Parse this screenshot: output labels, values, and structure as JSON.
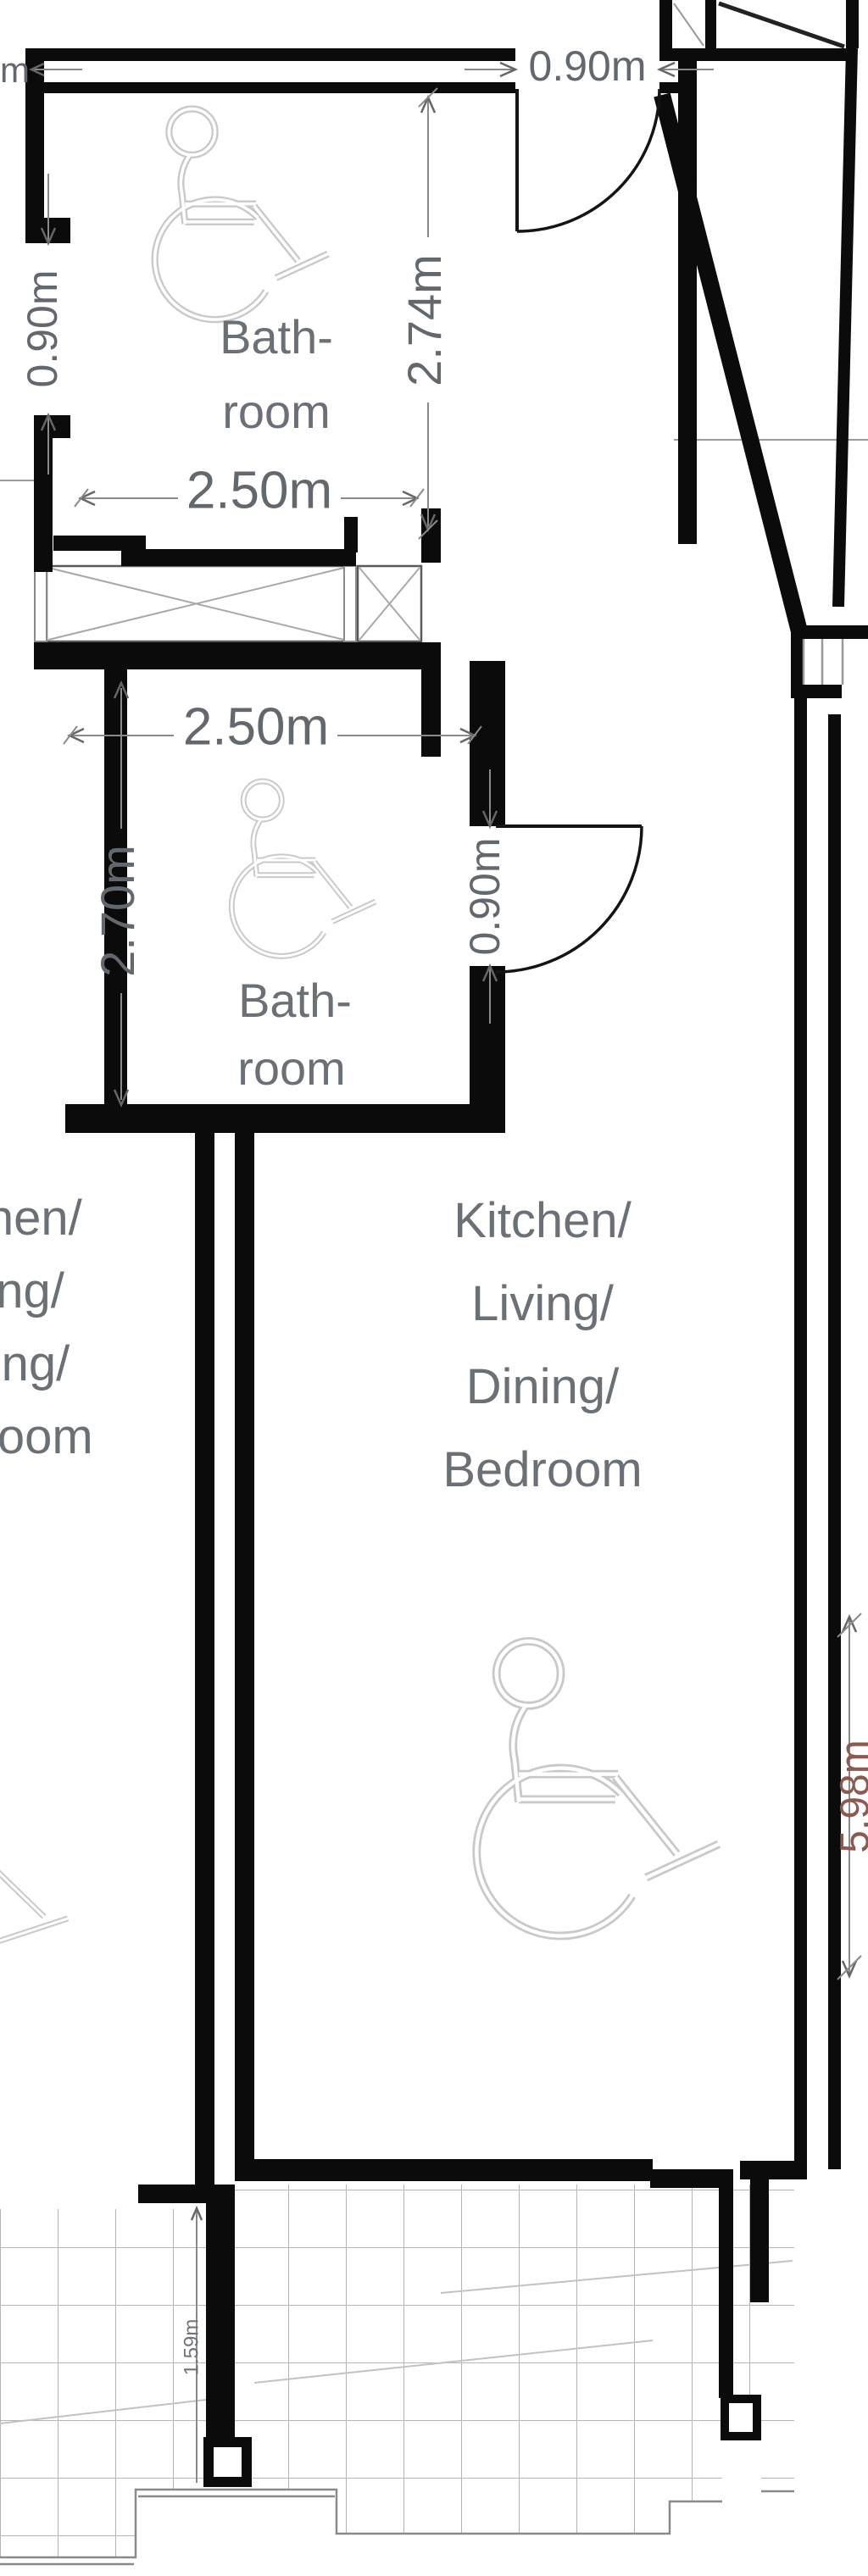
{
  "drawing": {
    "type": "architectural-floor-plan",
    "colors": {
      "wall": "#0b0b0b",
      "dim_line": "#8a8a8a",
      "dim_text": "#63686f",
      "room_label": "#6b7077",
      "wheelchair_icon": "#c9c9c9",
      "void_brace": "#a8a8a8",
      "tile_grid": "#b5b5b5",
      "right_dim_text": "#8b5a50"
    },
    "texts": {
      "top_left_fragment": "m",
      "dim_top_door": "0.90m",
      "dim_bath1_side_door": "0.90m",
      "dim_bath1_width": "2.50m",
      "dim_bath1_depth": "2.74m",
      "bath1_line1": "Bath-",
      "bath1_line2": "room",
      "dim_bath2_width": "2.50m",
      "dim_bath2_depth": "2.70m",
      "dim_bath2_door": "0.90m",
      "bath2_line1": "Bath-",
      "bath2_line2": "room",
      "main_line1": "Kitchen/",
      "main_line2": "Living/",
      "main_line3": "Dining/",
      "main_line4": "Bedroom",
      "neighbor_line1": "Kitchen/",
      "neighbor_line2": "Living/",
      "neighbor_line3": "Dining/",
      "neighbor_line4": "Bedroom",
      "dim_right_side": "5.98m",
      "dim_terrace": "1.59m"
    },
    "rooms": [
      {
        "name": "Bath-room (top)",
        "width": "2.50m",
        "depth": "2.74m",
        "door": "0.90m",
        "side_opening": "0.90m",
        "accessible": true
      },
      {
        "name": "Bath-room (middle)",
        "width": "2.50m",
        "depth": "2.70m",
        "door": "0.90m",
        "accessible": true
      },
      {
        "name": "Kitchen/Living/Dining/Bedroom",
        "accessible": true
      },
      {
        "name": "Kitchen/Living/Dining/Bedroom (adjacent unit, clipped at left edge)",
        "clipped": true
      }
    ],
    "icons": [
      {
        "name": "wheelchair-accessibility-icon",
        "count": 3,
        "style": "light-gray outline"
      },
      {
        "name": "door-swing-arc",
        "count": 2
      }
    ],
    "features": [
      "void-shaft-with-x-brace",
      "window-with-mullions",
      "tiled-terraces",
      "columns"
    ]
  }
}
